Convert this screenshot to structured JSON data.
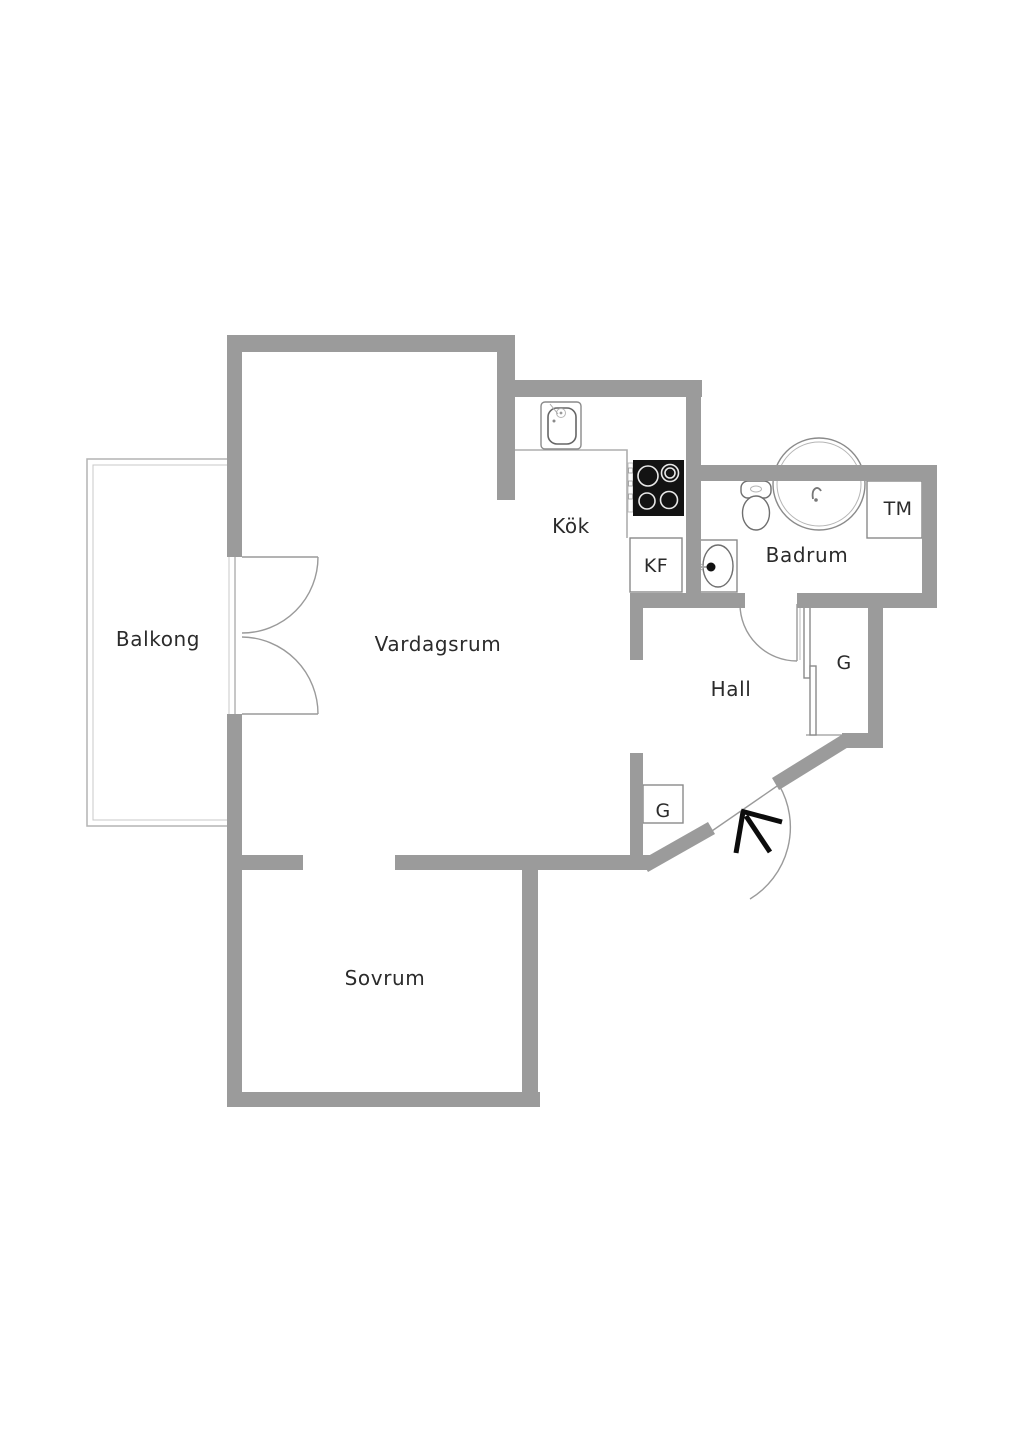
{
  "floorplan": {
    "rooms": {
      "balcony": {
        "label": "Balkong"
      },
      "living_room": {
        "label": "Vardagsrum"
      },
      "kitchen": {
        "label": "Kök"
      },
      "bathroom": {
        "label": "Badrum"
      },
      "hall": {
        "label": "Hall"
      },
      "bedroom": {
        "label": "Sovrum"
      }
    },
    "fixtures": {
      "fridge_freezer": {
        "label": "KF"
      },
      "washing_machine": {
        "label": "TM"
      },
      "wardrobe_right": {
        "label": "G"
      },
      "wardrobe_left": {
        "label": "G"
      }
    },
    "colors": {
      "wall": "#9b9b9b",
      "text": "#2b2b2b",
      "door-line": "#9a9a9a",
      "fixture-line": "#8a8a8a",
      "balcony-line": "#b4b4b4",
      "stove": "#131313",
      "bg": "#ffffff"
    }
  }
}
